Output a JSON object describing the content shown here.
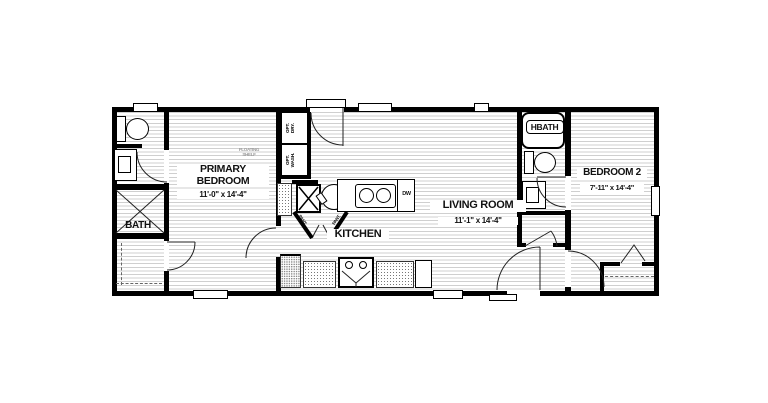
{
  "plan": {
    "rooms": {
      "primary_bedroom": {
        "name_line1": "PRIMARY",
        "name_line2": "BEDROOM",
        "dims": "11'-0\" x 14'-4\""
      },
      "bath": {
        "name": "BATH"
      },
      "kitchen": {
        "name": "KITCHEN"
      },
      "living_room": {
        "name": "LIVING ROOM",
        "dims": "11'-1\" x 14'-4\""
      },
      "hbath": {
        "name": "HBATH"
      },
      "bedroom_2": {
        "name": "BEDROOM 2",
        "dims": "7'-11\" x 14'-4\""
      }
    },
    "fixtures": {
      "opt_dry": {
        "line1": "OPT.",
        "line2": "DRY."
      },
      "opt_wash": {
        "line1": "OPT.",
        "line2": "WASH."
      },
      "dishwasher": "DW",
      "floating_shelf": {
        "line1": "FLOATING",
        "line2": "SHELF"
      },
      "pantry_left": "PANT.",
      "pantry_right": "PANT."
    },
    "colors": {
      "wall": "#000000",
      "floor_line": "#cccccc",
      "label": "#111111",
      "muted_label": "#9a9a9a"
    }
  }
}
